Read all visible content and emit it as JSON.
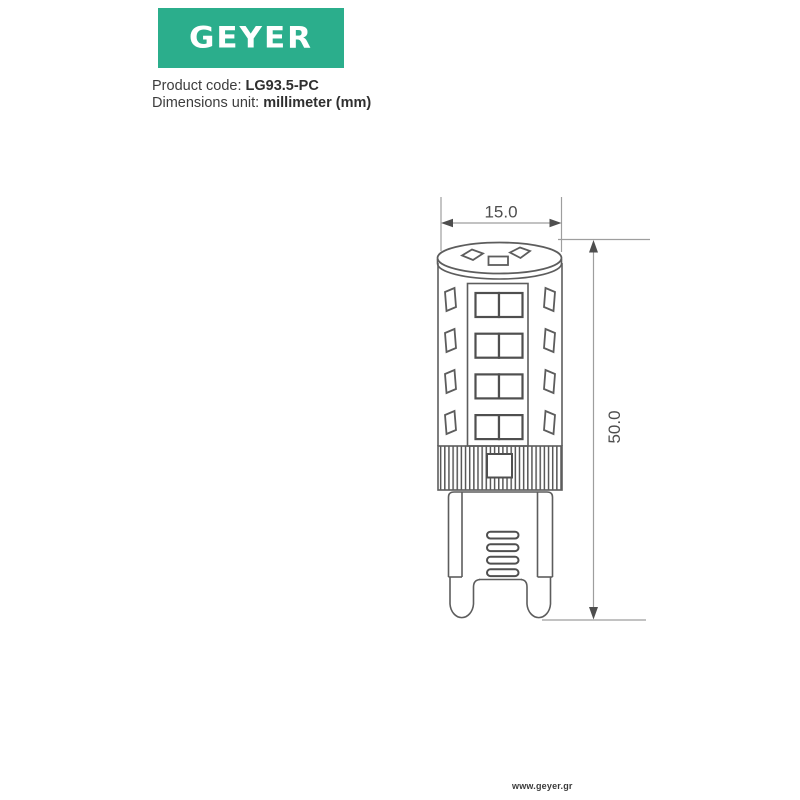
{
  "brand": {
    "logo_text": "GEYER",
    "logo_bg": "#2BAE8C",
    "logo_fg": "#FFFFFF",
    "website": "www.geyer.gr"
  },
  "product": {
    "code_label": "Product code: ",
    "code_value": "LG93.5-PC",
    "unit_label": "Dimensions unit: ",
    "unit_value": "millimeter (mm)"
  },
  "drawing": {
    "type": "technical-dimension-drawing",
    "subject": "G9 LED capsule lamp, front view",
    "unit": "mm",
    "width_mm": "15.0",
    "height_mm": "50.0",
    "dim_line_color": "#9E9E9E",
    "arrow_color": "#4E4E4E",
    "outline_color": "#5D5D5D"
  }
}
